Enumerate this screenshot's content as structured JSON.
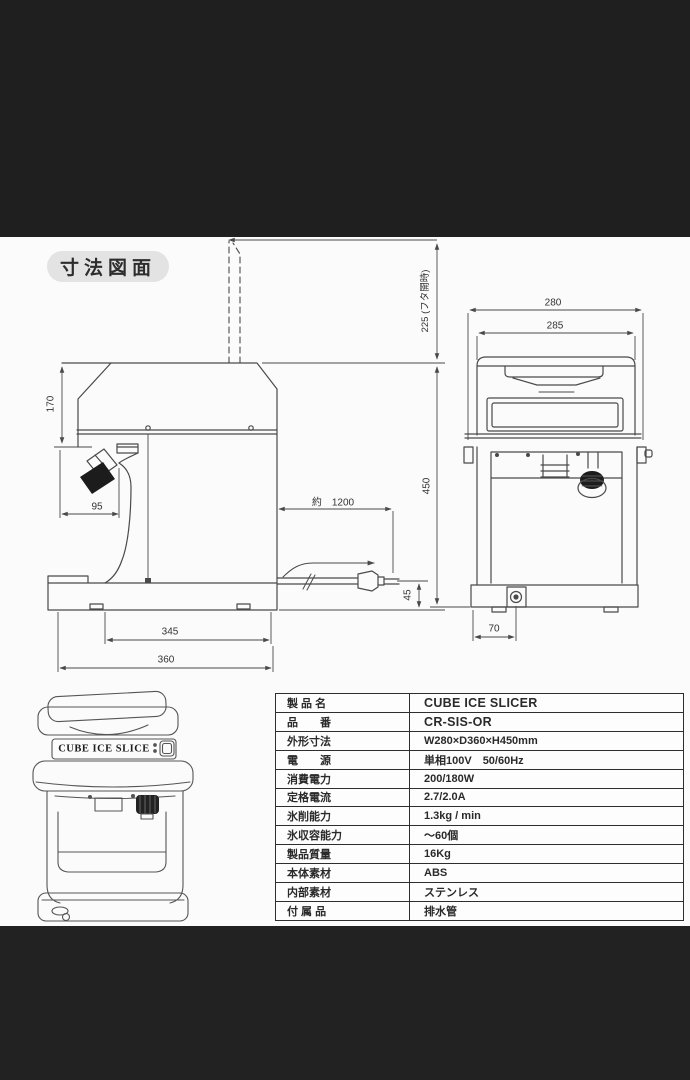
{
  "page": {
    "title_badge": "寸法図面"
  },
  "dimensions": {
    "lid_open": "225 (フタ開時)",
    "width_outer": "280",
    "width_lid": "285",
    "head_height": "170",
    "chute_width": "95",
    "cord_length": "約　1200",
    "total_height": "450",
    "cord_height": "45",
    "depth_inner": "345",
    "depth_total": "360",
    "drain_offset": "70"
  },
  "illustration": {
    "brand_label": "CUBE ICE SLICE"
  },
  "spec_table": {
    "rows": [
      {
        "label": "製 品 名",
        "value": "CUBE ICE SLICER"
      },
      {
        "label": "品　　番",
        "value": "CR-SIS-OR"
      },
      {
        "label": "外形寸法",
        "value": "W280×D360×H450mm"
      },
      {
        "label": "電　　源",
        "value": "単相100V　50/60Hz"
      },
      {
        "label": "消費電力",
        "value": "200/180W"
      },
      {
        "label": "定格電流",
        "value": "2.7/2.0A"
      },
      {
        "label": "氷削能力",
        "value": "1.3kg / min"
      },
      {
        "label": "氷収容能力",
        "value": "〜60個"
      },
      {
        "label": "製品質量",
        "value": "16Kg"
      },
      {
        "label": "本体素材",
        "value": "ABS"
      },
      {
        "label": "内部素材",
        "value": "ステンレス"
      },
      {
        "label": "付 属 品",
        "value": "排水管"
      }
    ]
  }
}
